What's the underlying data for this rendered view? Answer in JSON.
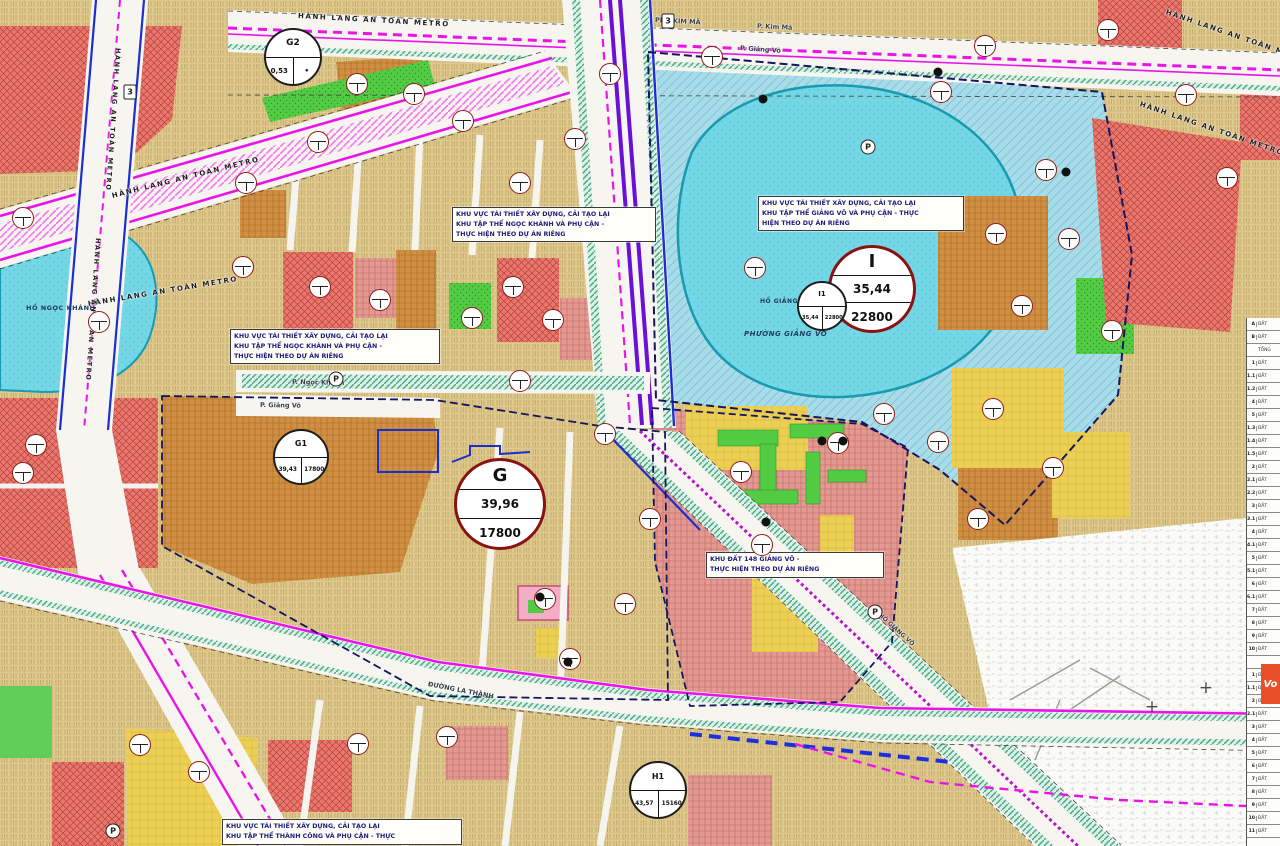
{
  "map": {
    "colors": {
      "metro_magenta": "#ea14ea",
      "metro_purple": "#6a10d8",
      "road_blue": "#1b2fd0",
      "boundary_navy": "#14165f",
      "lake_cyan": "#74d7e6",
      "zone_tan": "#dfc98c",
      "zone_red": "#e5786f",
      "zone_orange": "#d08f42",
      "zone_yellow": "#ecd055",
      "zone_green": "#52cc43",
      "zone_blue_hatch": "#a8dce9",
      "ring_dark_red": "#8b1212",
      "annotation_text": "#1c1c7c"
    },
    "annotation_boxes": [
      {
        "x": 230,
        "y": 329,
        "w": 202,
        "lines": [
          "KHU VỰC TÁI THIẾT XÂY DỰNG, CẢI TẠO LẠI",
          "KHU TẬP THỂ  NGỌC KHÁNH VÀ PHỤ CẬN -",
          "THỰC HIỆN THEO DỰ ÁN RIÊNG"
        ]
      },
      {
        "x": 452,
        "y": 207,
        "w": 196,
        "lines": [
          "KHU VỰC TÁI THIẾT XÂY DỰNG, CẢI TẠO LẠI",
          "KHU TẬP THỂ  NGỌC KHÁNH VÀ PHỤ CẬN -",
          "THỰC HIỆN THEO DỰ ÁN RIÊNG"
        ]
      },
      {
        "x": 758,
        "y": 196,
        "w": 198,
        "lines": [
          "KHU VỰC TÁI THIẾT XÂY DỰNG, CẢI TẠO LẠI",
          "KHU TẬP THỂ GIẢNG VÕ VÀ PHỤ CẬN - THỰC",
          "HIỆN THEO DỰ ÁN RIÊNG"
        ]
      },
      {
        "x": 706,
        "y": 552,
        "w": 170,
        "lines": [
          "KHU ĐẤT 148 GIẢNG VÕ -",
          "THỰC HIỆN THEO DỰ ÁN RIÊNG"
        ]
      },
      {
        "x": 222,
        "y": 819,
        "w": 232,
        "lines": [
          "KHU VỰC TÁI THIẾT XÂY DỰNG, CẢI TẠO LẠI",
          "KHU TẬP THỂ THÀNH CÔNG VÀ PHỤ CẬN - THỰC"
        ]
      }
    ],
    "zone_circles": [
      {
        "id": "G",
        "x": 500,
        "y": 504,
        "d": 92,
        "ring": "#8b1212",
        "rw": 3,
        "title": "G",
        "ts": 18,
        "rows": [
          "39,96",
          "17800"
        ],
        "rs": 12
      },
      {
        "id": "I",
        "x": 872,
        "y": 289,
        "d": 88,
        "ring": "#8b1212",
        "rw": 3,
        "title": "I",
        "ts": 18,
        "rows": [
          "35,44",
          "22800"
        ],
        "rs": 12
      },
      {
        "id": "G2",
        "x": 293,
        "y": 57,
        "d": 58,
        "ring": "#1d1d1d",
        "rw": 2.6,
        "title": "G2",
        "ts": 9,
        "cells": [
          "0,53",
          "•"
        ],
        "cs": 7
      },
      {
        "id": "G1",
        "x": 301,
        "y": 457,
        "d": 56,
        "ring": "#1d1d1d",
        "rw": 2.6,
        "title": "G1",
        "ts": 8,
        "cells": [
          "39,43",
          "17800"
        ],
        "cs": 5.8
      },
      {
        "id": "I1",
        "x": 822,
        "y": 306,
        "d": 50,
        "ring": "#1d1d1d",
        "rw": 2.2,
        "title": "I1",
        "ts": 7,
        "cells": [
          "35,44",
          "22800"
        ],
        "cs": 5.2
      },
      {
        "id": "H1",
        "x": 658,
        "y": 790,
        "d": 58,
        "ring": "#1d1d1d",
        "rw": 2.6,
        "title": "H1",
        "ts": 8,
        "cells": [
          "43,57",
          "15160"
        ],
        "cs": 5.8
      }
    ],
    "metro_labels": [
      {
        "text": "HÀNH LANG AN TOÀN METRO",
        "x": 112,
        "y": 192,
        "r": -14,
        "s": 7
      },
      {
        "text": "HÀNH LANG AN TOÀN METRO",
        "x": 88,
        "y": 300,
        "r": -9.5,
        "s": 7
      },
      {
        "text": "HÀNH LANG AN TOÀN METRO",
        "x": 298,
        "y": 12,
        "r": 3.2,
        "s": 7
      },
      {
        "text": "HÀNH LANG AN TOÀN METRO",
        "x": 1166,
        "y": 8,
        "r": 19,
        "s": 7
      },
      {
        "text": "HÀNH LANG AN TOÀN METRO",
        "x": 1140,
        "y": 100,
        "r": 19,
        "s": 7
      },
      {
        "text": "HÀNH LANG AN TOÀN METRO",
        "x": 118,
        "y": 44,
        "r": 94,
        "s": 6.5
      },
      {
        "text": "HÀNH LANG AN TOÀN METRO",
        "x": 98,
        "y": 234,
        "r": 94,
        "s": 6.5
      }
    ],
    "street_labels": [
      {
        "text": "PHỐ KIM MÃ",
        "x": 655,
        "y": 16,
        "r": 3,
        "s": 6.5
      },
      {
        "text": "P. Kim Mã",
        "x": 757,
        "y": 22,
        "r": 3,
        "s": 6.5
      },
      {
        "text": "P. Giảng Võ",
        "x": 740,
        "y": 44,
        "r": 4,
        "s": 6.5
      },
      {
        "text": "P. Ngọc Khánh",
        "x": 292,
        "y": 378,
        "r": 1,
        "s": 6.5
      },
      {
        "text": "P. Giảng Võ",
        "x": 260,
        "y": 401,
        "r": 1,
        "s": 6.5
      },
      {
        "text": "ĐƯỜNG LA THÀNH",
        "x": 428,
        "y": 680,
        "r": 11,
        "s": 6.5
      },
      {
        "text": "PHỐ GIẢNG VÕ",
        "x": 876,
        "y": 608,
        "r": 42,
        "s": 6
      }
    ],
    "water_labels": [
      {
        "text": "HỒ NGỌC KHÁNH",
        "x": 26,
        "y": 304,
        "s": 6.5,
        "b": 0
      },
      {
        "text": "HỒ GIẢNG VÕ",
        "x": 760,
        "y": 298,
        "s": 6,
        "b": 0
      },
      {
        "text": "PHƯỜNG GIẢNG VÕ",
        "x": 744,
        "y": 330,
        "s": 7,
        "b": 1
      }
    ],
    "parcel_badges": [
      {
        "x": 23,
        "y": 218
      },
      {
        "x": 99,
        "y": 322
      },
      {
        "x": 23,
        "y": 473
      },
      {
        "x": 36,
        "y": 445
      },
      {
        "x": 140,
        "y": 745
      },
      {
        "x": 199,
        "y": 772
      },
      {
        "x": 246,
        "y": 183
      },
      {
        "x": 318,
        "y": 142
      },
      {
        "x": 357,
        "y": 84
      },
      {
        "x": 414,
        "y": 94
      },
      {
        "x": 463,
        "y": 121
      },
      {
        "x": 520,
        "y": 183
      },
      {
        "x": 575,
        "y": 139
      },
      {
        "x": 610,
        "y": 74
      },
      {
        "x": 712,
        "y": 57
      },
      {
        "x": 941,
        "y": 92
      },
      {
        "x": 985,
        "y": 46
      },
      {
        "x": 1046,
        "y": 170
      },
      {
        "x": 1108,
        "y": 30
      },
      {
        "x": 1186,
        "y": 95
      },
      {
        "x": 1227,
        "y": 178
      },
      {
        "x": 1069,
        "y": 239
      },
      {
        "x": 996,
        "y": 234
      },
      {
        "x": 1022,
        "y": 306
      },
      {
        "x": 1112,
        "y": 331
      },
      {
        "x": 243,
        "y": 267
      },
      {
        "x": 320,
        "y": 287
      },
      {
        "x": 380,
        "y": 300
      },
      {
        "x": 472,
        "y": 318
      },
      {
        "x": 513,
        "y": 287
      },
      {
        "x": 553,
        "y": 320
      },
      {
        "x": 605,
        "y": 434
      },
      {
        "x": 650,
        "y": 519
      },
      {
        "x": 545,
        "y": 599
      },
      {
        "x": 570,
        "y": 659
      },
      {
        "x": 625,
        "y": 604
      },
      {
        "x": 520,
        "y": 381
      },
      {
        "x": 358,
        "y": 744
      },
      {
        "x": 447,
        "y": 737
      },
      {
        "x": 762,
        "y": 545
      },
      {
        "x": 741,
        "y": 472
      },
      {
        "x": 838,
        "y": 443
      },
      {
        "x": 884,
        "y": 414
      },
      {
        "x": 938,
        "y": 442
      },
      {
        "x": 993,
        "y": 409
      },
      {
        "x": 978,
        "y": 519
      },
      {
        "x": 1053,
        "y": 468
      },
      {
        "x": 755,
        "y": 268
      }
    ],
    "black_dots": [
      {
        "x": 763,
        "y": 99
      },
      {
        "x": 938,
        "y": 72
      },
      {
        "x": 1066,
        "y": 172
      },
      {
        "x": 822,
        "y": 441
      },
      {
        "x": 843,
        "y": 441
      },
      {
        "x": 568,
        "y": 662
      },
      {
        "x": 540,
        "y": 597
      },
      {
        "x": 766,
        "y": 522
      }
    ],
    "parking_icons": [
      {
        "label": "P",
        "x": 336,
        "y": 379
      },
      {
        "label": "P",
        "x": 868,
        "y": 147
      },
      {
        "label": "P",
        "x": 875,
        "y": 612
      },
      {
        "label": "P",
        "x": 113,
        "y": 831
      }
    ],
    "route_markers": [
      {
        "label": "3",
        "x": 130,
        "y": 92
      },
      {
        "label": "3",
        "x": 668,
        "y": 21
      }
    ],
    "crosshairs": [
      {
        "glyph": "+",
        "x": 1152,
        "y": 707
      },
      {
        "glyph": "+",
        "x": 1206,
        "y": 688
      }
    ],
    "legend": {
      "circle_plus": {
        "glyph": "+",
        "x": 1253,
        "y": 506
      },
      "logo_text": "Vo",
      "rows": [
        {
          "n": "A",
          "t": "ĐẤT"
        },
        {
          "n": "B",
          "t": "ĐẤT"
        },
        {
          "n": "",
          "t": "TỔNG"
        },
        {
          "n": "1",
          "t": "ĐẤT"
        },
        {
          "n": "1.1",
          "t": "ĐẤT"
        },
        {
          "n": "1.2",
          "t": "ĐẤT"
        },
        {
          "n": "4",
          "t": "ĐẤT"
        },
        {
          "n": "5",
          "t": "ĐẤT"
        },
        {
          "n": "1.3",
          "t": "ĐẤT"
        },
        {
          "n": "1.4",
          "t": "ĐẤT"
        },
        {
          "n": "1.5",
          "t": "ĐẤT"
        },
        {
          "n": "2",
          "t": "ĐẤT"
        },
        {
          "n": "2.1",
          "t": "ĐẤT"
        },
        {
          "n": "2.2",
          "t": "ĐẤT"
        },
        {
          "n": "3",
          "t": "ĐẤT"
        },
        {
          "n": "3.1",
          "t": "ĐẤT"
        },
        {
          "n": "4",
          "t": "ĐẤT"
        },
        {
          "n": "4.1",
          "t": "ĐẤT"
        },
        {
          "n": "5",
          "t": "ĐẤT"
        },
        {
          "n": "5.1",
          "t": "ĐẤT"
        },
        {
          "n": "6",
          "t": "ĐẤT"
        },
        {
          "n": "6.1",
          "t": "ĐẤT"
        },
        {
          "n": "7",
          "t": "ĐẤT"
        },
        {
          "n": "8",
          "t": "ĐẤT"
        },
        {
          "n": "9",
          "t": "ĐẤT"
        },
        {
          "n": "10",
          "t": "ĐẤT"
        },
        {
          "n": "",
          "t": ""
        },
        {
          "n": "1",
          "t": "ĐẤT"
        },
        {
          "n": "1.1",
          "t": "ĐẤT"
        },
        {
          "n": "2",
          "t": "ĐẤT"
        },
        {
          "n": "2.1",
          "t": "ĐẤT"
        },
        {
          "n": "3",
          "t": "ĐẤT"
        },
        {
          "n": "4",
          "t": "ĐẤT"
        },
        {
          "n": "5",
          "t": "ĐẤT"
        },
        {
          "n": "6",
          "t": "ĐẤT"
        },
        {
          "n": "7",
          "t": "ĐẤT"
        },
        {
          "n": "8",
          "t": "ĐẤT"
        },
        {
          "n": "9",
          "t": "ĐẤT"
        },
        {
          "n": "10",
          "t": "ĐẤT"
        },
        {
          "n": "11",
          "t": "ĐẤT"
        }
      ]
    }
  }
}
